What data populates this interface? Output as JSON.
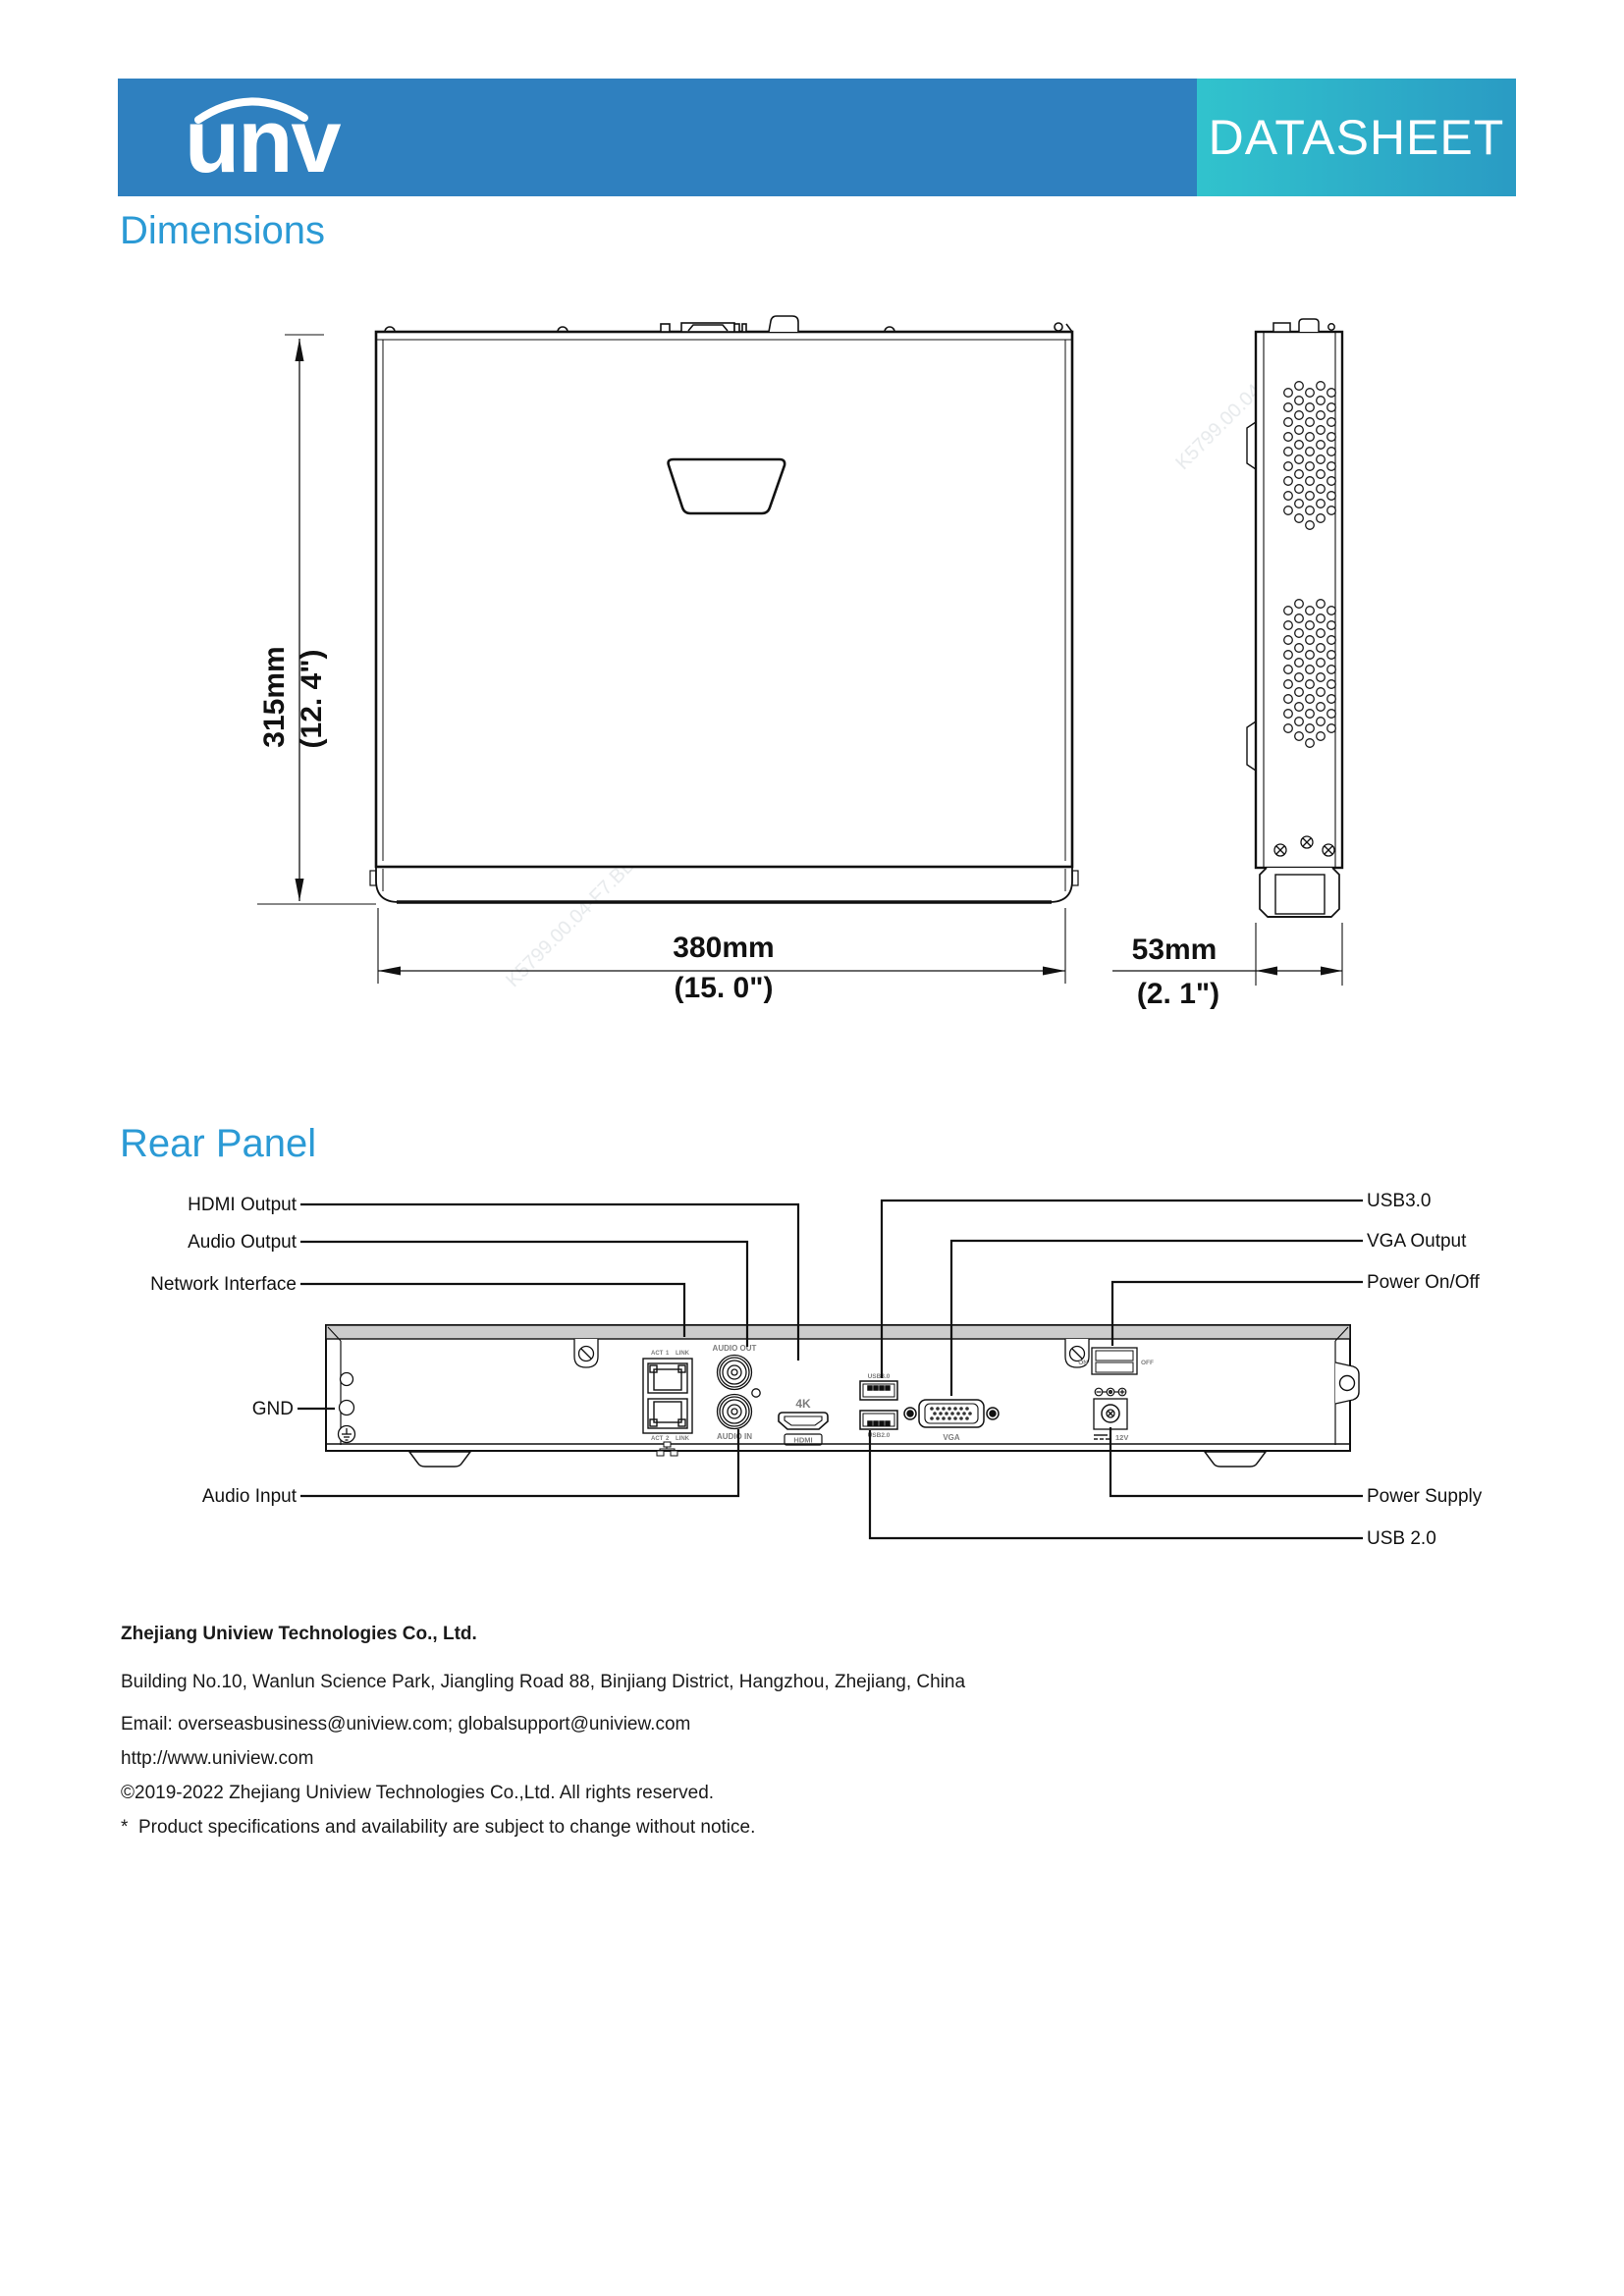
{
  "header": {
    "logo": "unv",
    "banner": "DATASHEET"
  },
  "headings": {
    "dimensions": "Dimensions",
    "rear_panel": "Rear Panel"
  },
  "dimensions_figure": {
    "height_mm": "315mm",
    "height_in": "(12. 4\")",
    "width_mm": "380mm",
    "width_in": "(15. 0\")",
    "depth_mm": "53mm",
    "depth_in": "(2. 1\")",
    "watermark": "K5799.00.04-F7.BB"
  },
  "rear_panel_figure": {
    "callouts_left": [
      "HDMI Output",
      "Audio Output",
      "Network Interface",
      "GND",
      "Audio Input"
    ],
    "callouts_right": [
      "USB3.0",
      "VGA Output",
      "Power On/Off",
      "Power Supply",
      "USB 2.0"
    ],
    "ports": {
      "audio_out": "AUDIO OUT",
      "audio_in": "AUDIO IN",
      "fourk": "4K",
      "hdmi": "HDMI",
      "usb3": "USB3.0",
      "usb2": "USB2.0",
      "vga": "VGA",
      "on": "ON",
      "off": "OFF",
      "v12": "12V",
      "act": "ACT",
      "n1": "1",
      "n2": "2",
      "link": "LINK"
    }
  },
  "footer": {
    "company": "Zhejiang Uniview Technologies Co., Ltd.",
    "address": "Building No.10, Wanlun Science Park, Jiangling Road 88, Binjiang District, Hangzhou, Zhejiang, China",
    "email": "Email: overseasbusiness@uniview.com; globalsupport@uniview.com",
    "website": "http://www.uniview.com",
    "copyright": "©2019-2022 Zhejiang Uniview Technologies Co.,Ltd. All rights reserved.",
    "note": "*  Product specifications and availability are subject to change without notice."
  }
}
